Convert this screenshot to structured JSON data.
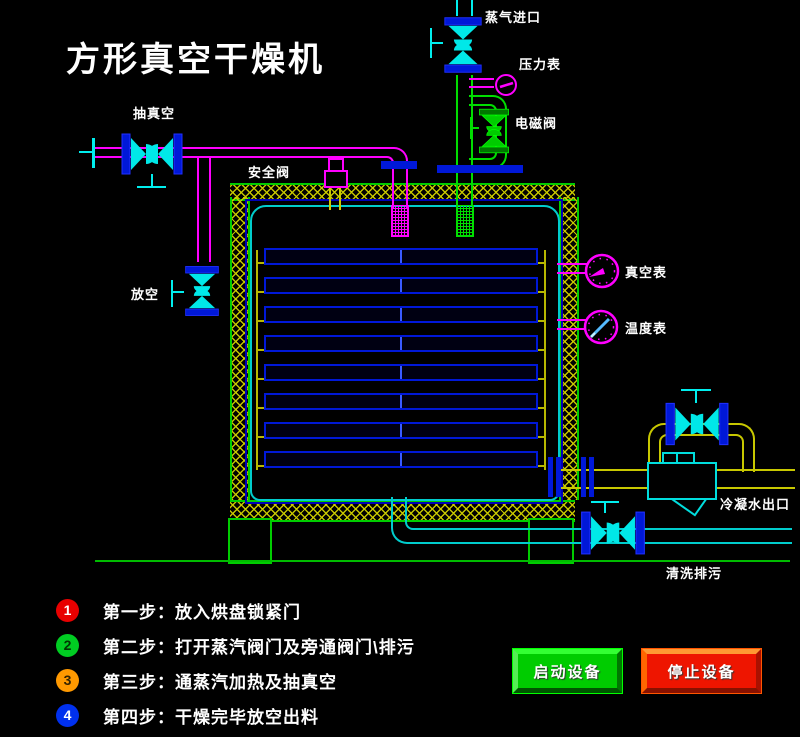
{
  "title": "方形真空干燥机",
  "labels": {
    "steam_inlet": "蒸气进口",
    "pressure_gauge": "压力表",
    "solenoid_valve": "电磁阀",
    "vacuum_suction": "抽真空",
    "safety_valve": "安全阀",
    "vent": "放空",
    "vacuum_gauge": "真空表",
    "temperature_gauge": "温度表",
    "condensate_outlet": "冷凝水出口",
    "flush_drain": "清洗排污"
  },
  "steps": [
    {
      "num": "1",
      "badge_color": "#e80000",
      "num_color": "#ffffff",
      "label": "第一步：放入烘盘锁紧门"
    },
    {
      "num": "2",
      "badge_color": "#00cc22",
      "num_color": "#003300",
      "label": "第二步：打开蒸汽阀门及旁通阀门\\排污"
    },
    {
      "num": "3",
      "badge_color": "#ff9900",
      "num_color": "#332200",
      "label": "第三步：通蒸汽加热及抽真空"
    },
    {
      "num": "4",
      "badge_color": "#0030ee",
      "num_color": "#ffffff",
      "label": "第四步：干燥完毕放空出料"
    }
  ],
  "buttons": {
    "start": {
      "label": "启动设备",
      "face_color": "#00cc00",
      "edge_color": "#007700"
    },
    "stop": {
      "label": "停止设备",
      "face_color": "#ee1500",
      "edge_color": "#ff7700"
    }
  },
  "colors": {
    "pipe_vacuum": "#ff00ff",
    "pipe_steam": "#00dd00",
    "pipe_cyan": "#00eeee",
    "pipe_condensate": "#c8c800",
    "flange_blue": "#0018d8",
    "tank_border": "#00cc00",
    "vessel_inner": "#00cccc"
  }
}
